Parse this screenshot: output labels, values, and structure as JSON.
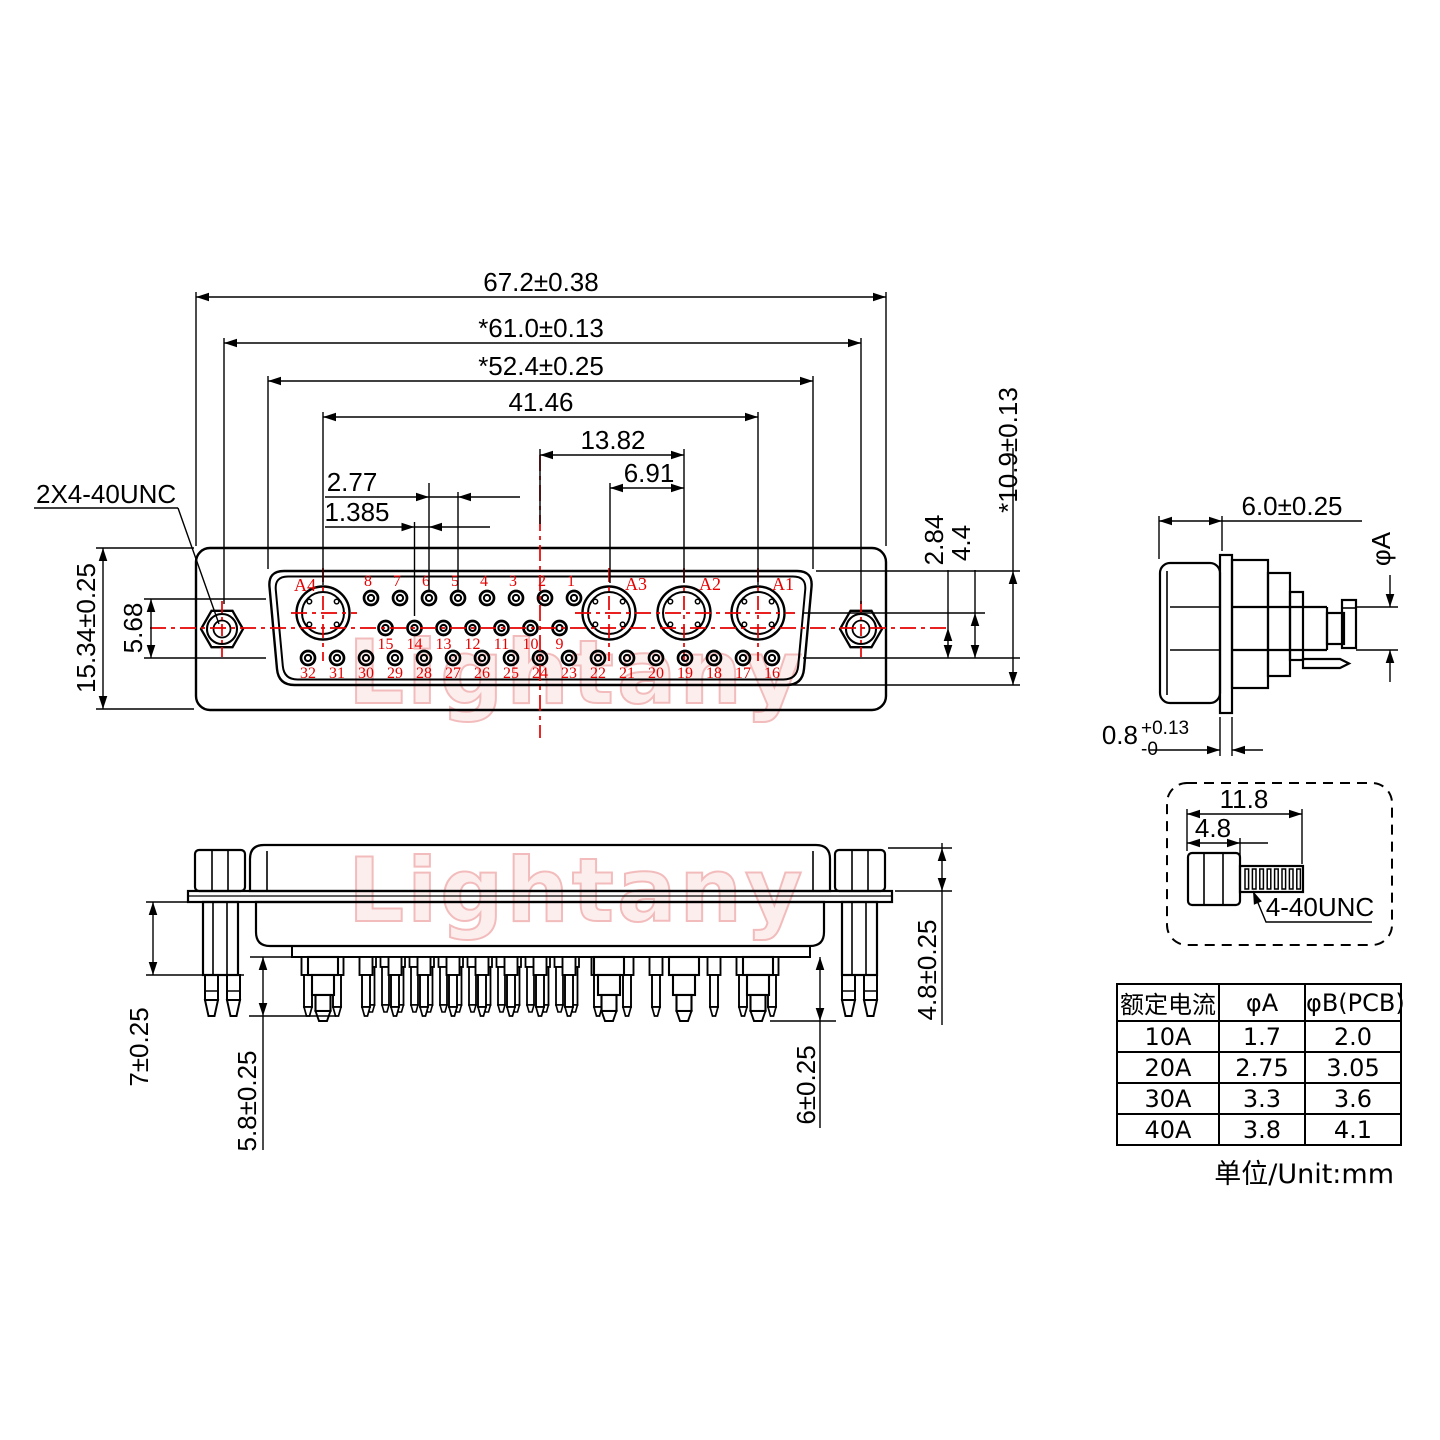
{
  "watermark": {
    "text": "Lightany"
  },
  "colors": {
    "line": "#000000",
    "accent_red": "#e60000",
    "watermark_stroke": "#f3bcbc",
    "watermark_fill": "#fdeeee"
  },
  "front_view": {
    "thread_label": "2X4-40UNC",
    "dims": {
      "overall_width": "67.2±0.38",
      "mount_span": "*61.0±0.13",
      "shell_width": "*52.4±0.25",
      "coax_span": "41.46",
      "center_to_a2": "13.82",
      "a3_to_a2": "6.91",
      "pitch": "2.77",
      "half_pitch": "1.385",
      "overall_height": "15.34±0.25",
      "row_span": "5.68",
      "row_step": "2.84",
      "center_drop": "4.4",
      "shell_height": "*10.9±0.13"
    },
    "pins": {
      "top": [
        "8",
        "7",
        "6",
        "5",
        "4",
        "3",
        "2",
        "1"
      ],
      "middle": [
        "15",
        "14",
        "13",
        "12",
        "11",
        "10",
        "9"
      ],
      "bottom": [
        "32",
        "31",
        "30",
        "29",
        "28",
        "27",
        "26",
        "25",
        "24",
        "23",
        "22",
        "21",
        "20",
        "19",
        "18",
        "17",
        "16"
      ],
      "coax": [
        "A4",
        "A3",
        "A2",
        "A1"
      ]
    }
  },
  "side_view": {
    "depth": "6.0±0.25",
    "pin_dia": "φA",
    "flange_thickness": "0.8",
    "tol_plus": "+0.13",
    "tol_minus": "-0"
  },
  "screw_detail": {
    "total_length": "11.8",
    "head_length": "4.8",
    "thread_label": "4-40UNC"
  },
  "bottom_view": {
    "standoff_length": "7±0.25",
    "pin_length": "5.8±0.25",
    "coax_pin_length": "6±0.25",
    "shell_height": "4.8±0.25"
  },
  "table": {
    "headers": [
      "额定电流",
      "φA",
      "φB(PCB)"
    ],
    "rows": [
      [
        "10A",
        "1.7",
        "2.0"
      ],
      [
        "20A",
        "2.75",
        "3.05"
      ],
      [
        "30A",
        "3.3",
        "3.6"
      ],
      [
        "40A",
        "3.8",
        "4.1"
      ]
    ],
    "unit_note": "单位/Unit:mm"
  }
}
